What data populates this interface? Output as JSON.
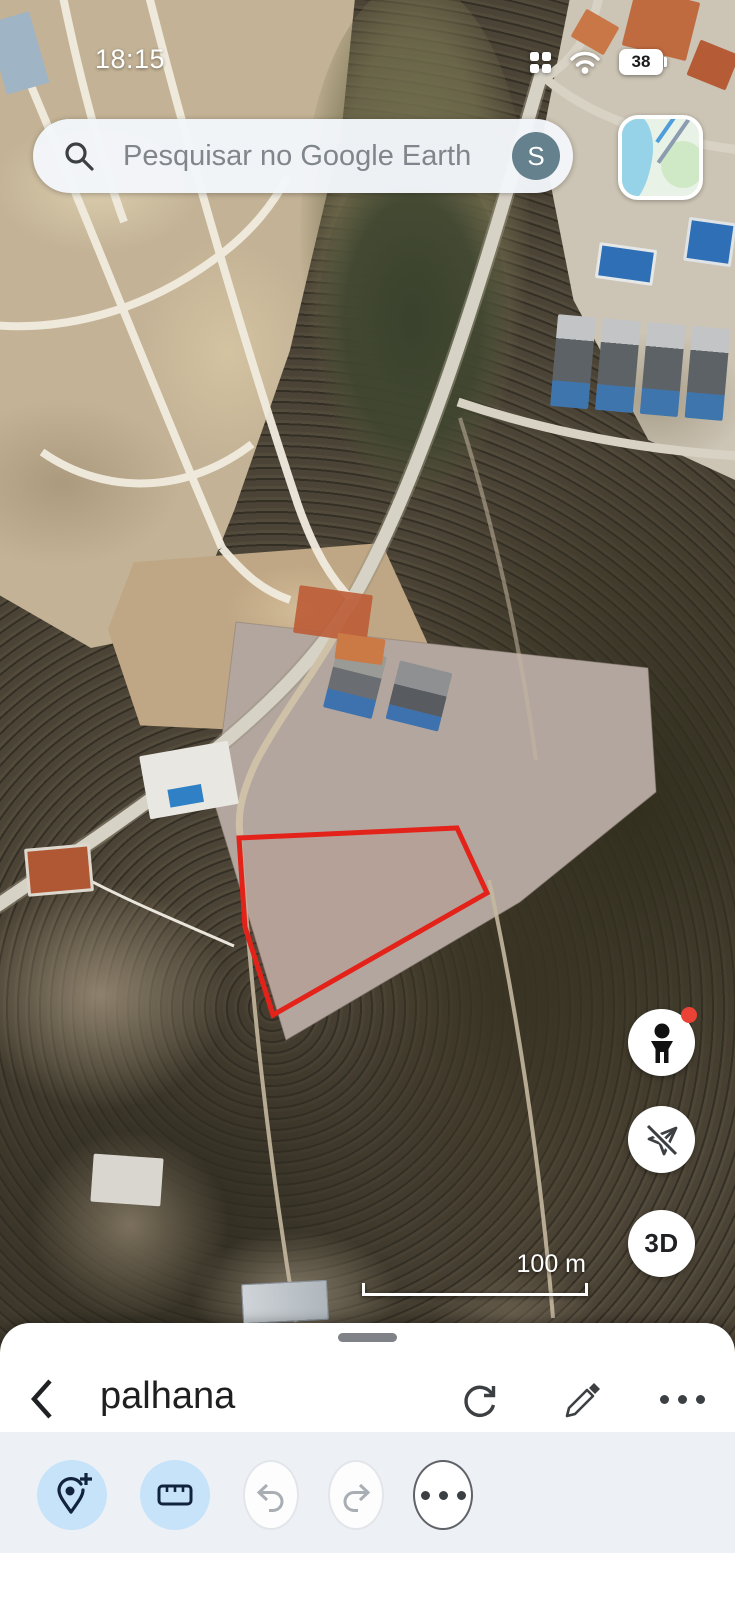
{
  "status_bar": {
    "time": "18:15",
    "battery_percent": "38"
  },
  "search_bar": {
    "placeholder": "Pesquisar no Google Earth",
    "account_initial": "S"
  },
  "map": {
    "scale_bar_label": "100 m",
    "three_d_label": "3D",
    "parcel_outline_color": "#e3231a",
    "fab_icons": [
      "pegman-street-view",
      "fly-mode-disabled",
      "3d-toggle"
    ]
  },
  "bottom_sheet": {
    "project_title": "palhana",
    "header_icons": [
      "back-chevron",
      "refresh",
      "edit-pencil",
      "more-options"
    ],
    "toolbar_icons": [
      "add-placemark",
      "measure-ruler",
      "undo",
      "redo",
      "more-tools"
    ],
    "active_tool_color": "#c6e3f9"
  }
}
